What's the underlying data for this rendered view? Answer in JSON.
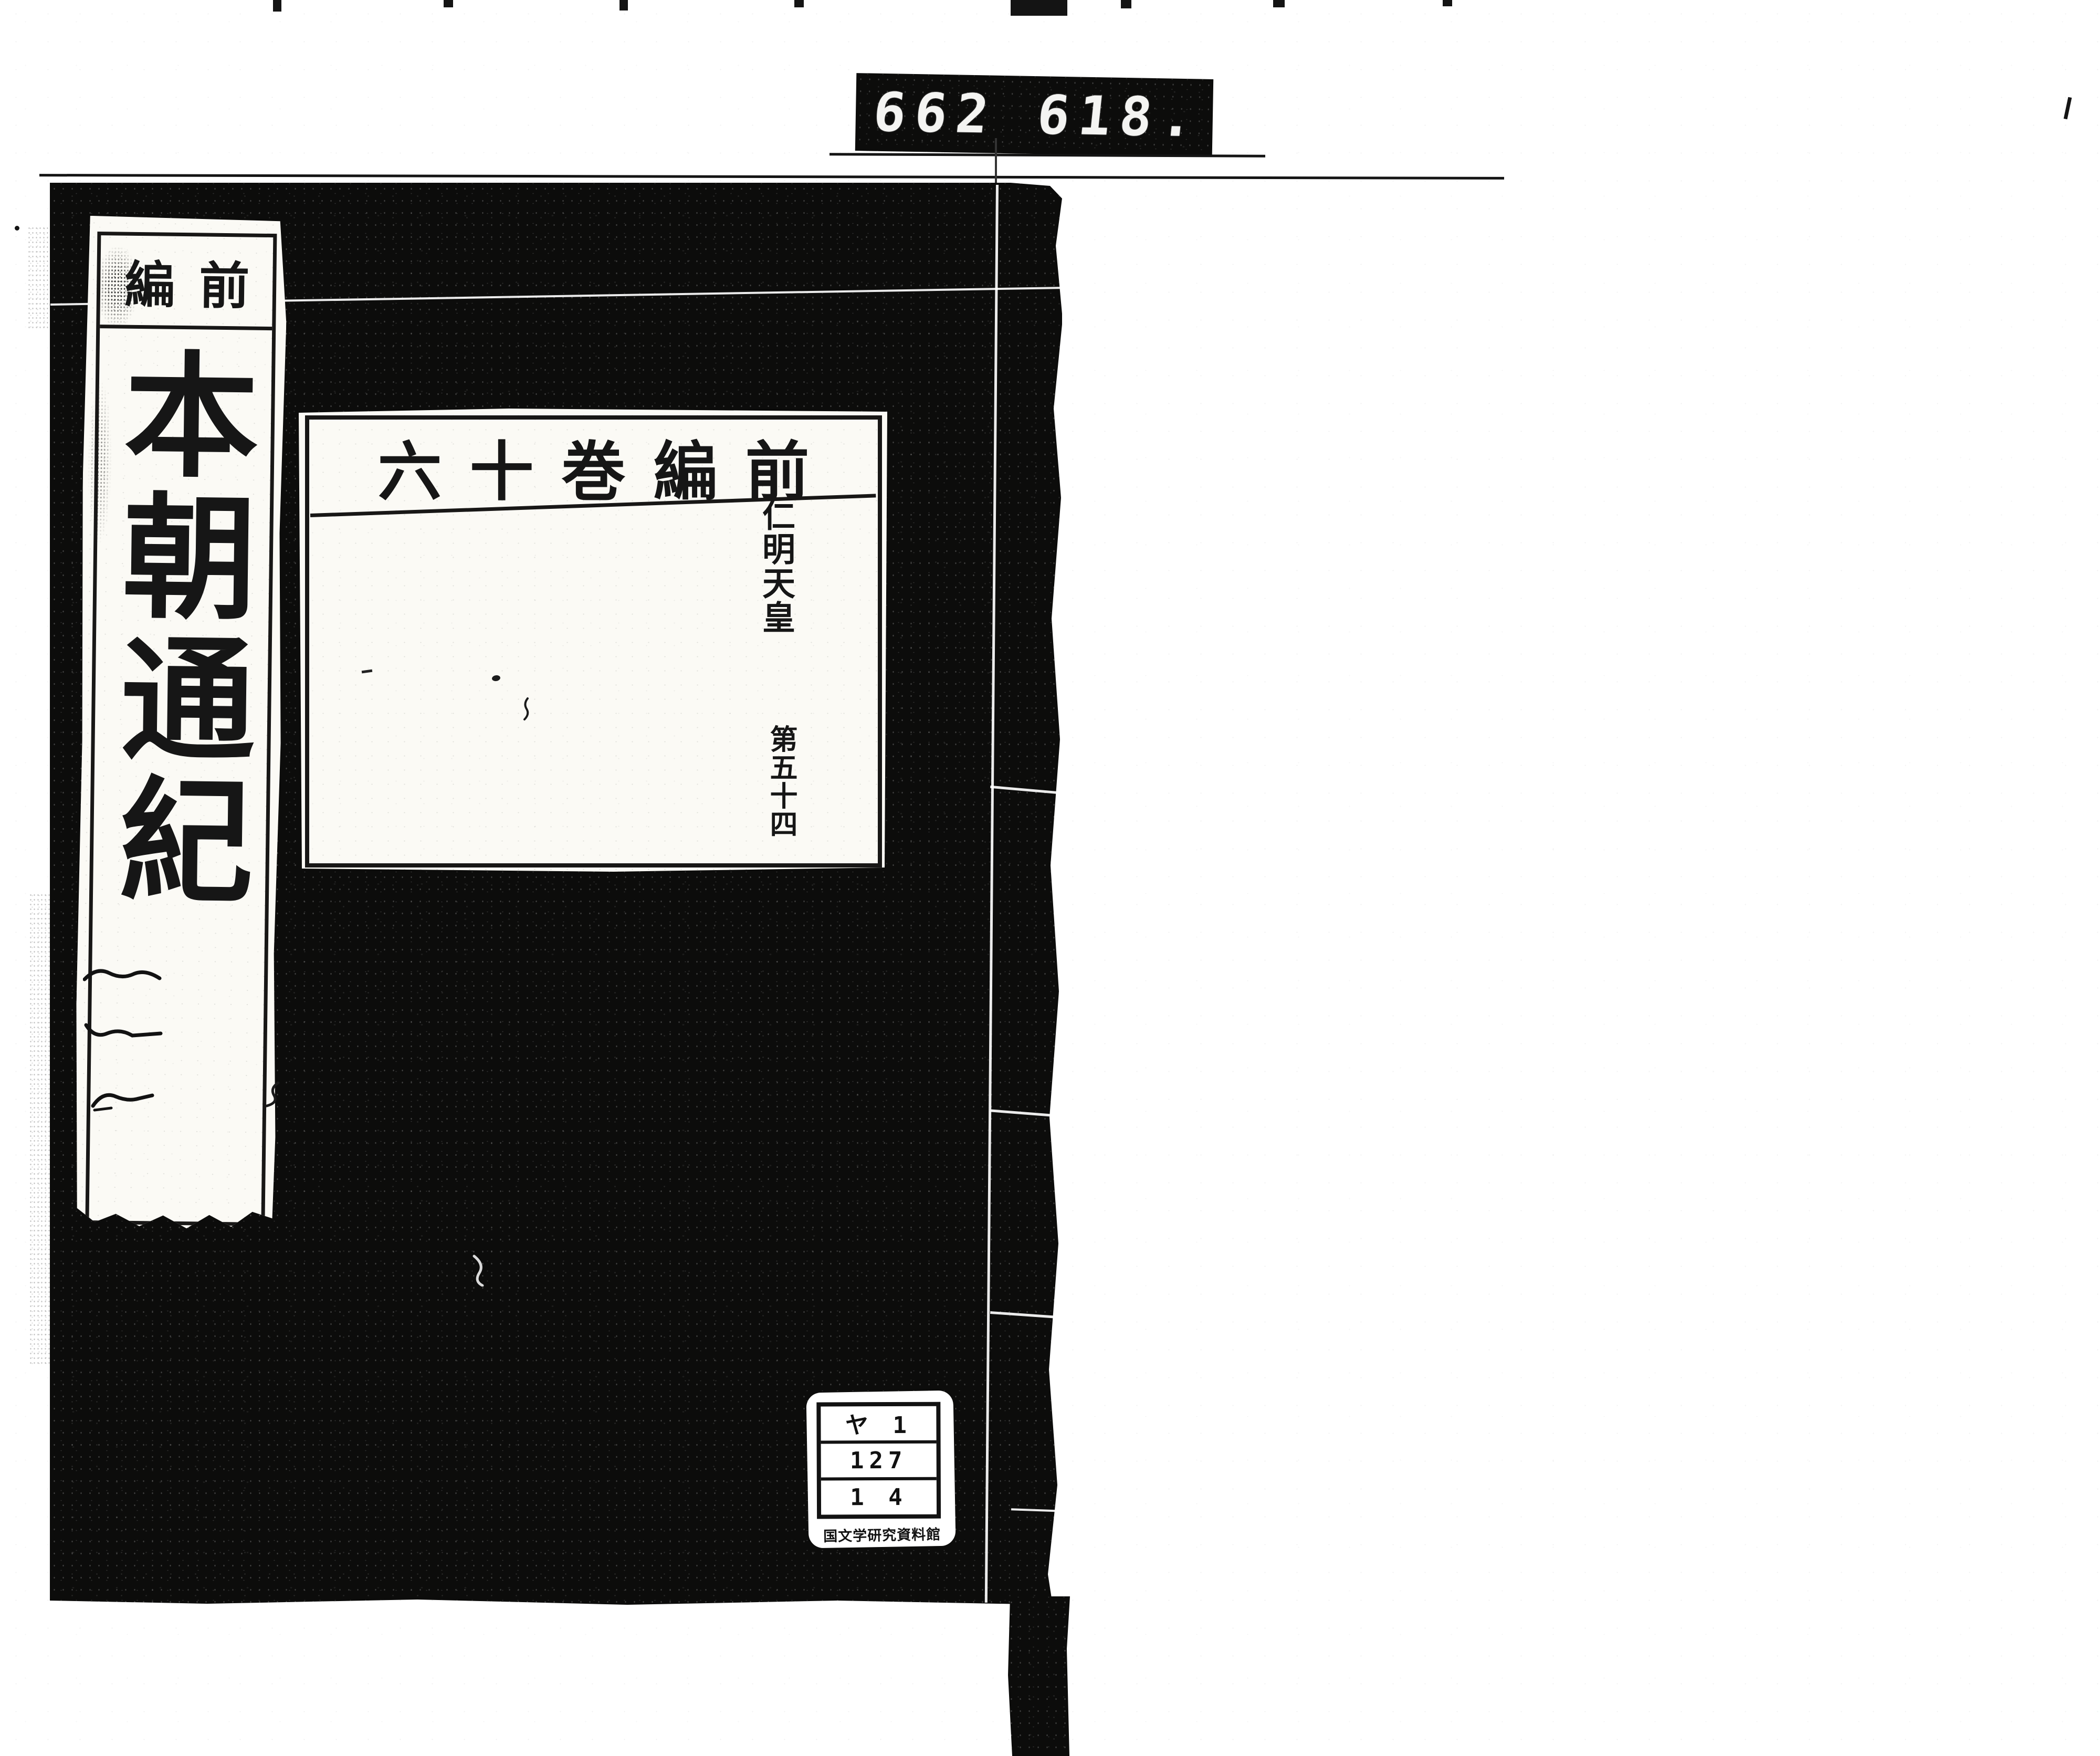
{
  "film_counter": {
    "left_digits": "662",
    "right_digits": "618."
  },
  "title_slip": {
    "series_header": "前編",
    "title": "本朝通紀"
  },
  "volume_label": {
    "series_header": "前編巻十六",
    "regnal_line": "仁明天皇",
    "volume_number": "第五十四"
  },
  "call_number_sticker": {
    "row1": "ヤ 1",
    "row2": "127",
    "row3": "1 4",
    "institution": "国文学研究資料館"
  },
  "colors": {
    "cover_black": "#0c0c0b",
    "ink_black": "#161616",
    "paper_white": "#fbfaf5",
    "page_white": "#ffffff"
  }
}
